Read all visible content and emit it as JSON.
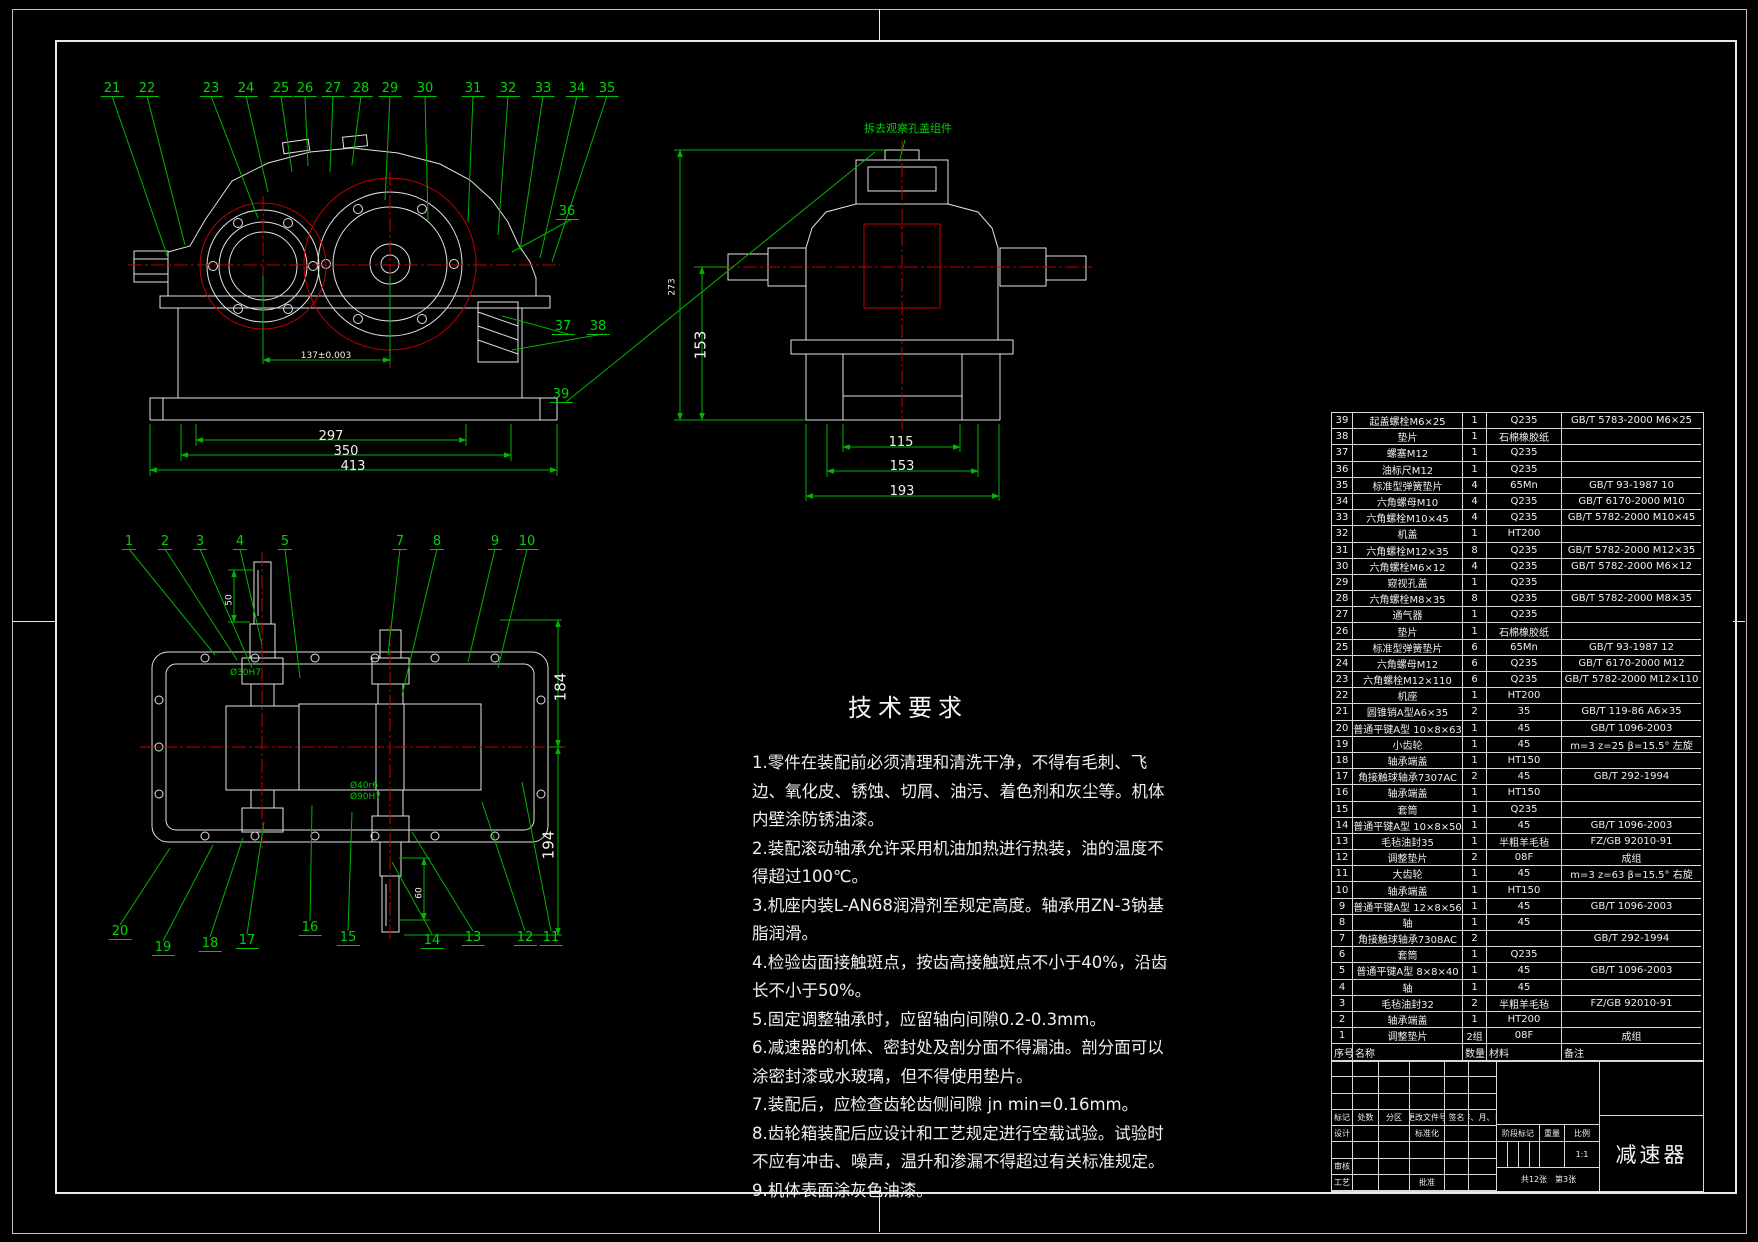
{
  "note": "拆去观察孔盖组件",
  "tech_requirements": {
    "title": "技术要求",
    "items": [
      "1.零件在装配前必须清理和清洗干净，不得有毛刺、飞边、氧化皮、锈蚀、切屑、油污、着色剂和灰尘等。机体内壁涂防锈油漆。",
      "2.装配滚动轴承允许采用机油加热进行热装，油的温度不得超过100℃。",
      "3.机座内装L-AN68润滑剂至规定高度。轴承用ZN-3钠基脂润滑。",
      "4.检验齿面接触斑点，按齿高接触斑点不小于40%，沿齿长不小于50%。",
      "5.固定调整轴承时，应留轴向间隙0.2-0.3mm。",
      "6.减速器的机体、密封处及剖分面不得漏油。剖分面可以涂密封漆或水玻璃，但不得使用垫片。",
      "7.装配后，应检查齿轮齿侧间隙 jn min=0.16mm。",
      "8.齿轮箱装配后应设计和工艺规定进行空载试验。试验时不应有冲击、噪声，温升和渗漏不得超过有关标准规定。",
      "9.机体表面涂灰色油漆。"
    ]
  },
  "balloons": {
    "top": [
      "21",
      "22",
      "23",
      "24",
      "25",
      "26",
      "27",
      "28",
      "29",
      "30",
      "31",
      "32",
      "33",
      "34",
      "35"
    ],
    "right": [
      "36",
      "37",
      "38",
      "39"
    ],
    "plan_top": [
      "1",
      "2",
      "3",
      "4",
      "5",
      "7",
      "8",
      "9",
      "10"
    ],
    "plan_bottom": [
      "20",
      "19",
      "18",
      "17",
      "16",
      "15",
      "14",
      "13",
      "12",
      "11"
    ]
  },
  "dimensions": {
    "front": {
      "width1": "297",
      "width2": "350",
      "width3": "413",
      "center_distance": "137±0.003"
    },
    "side": {
      "height_total": "273",
      "height_base": "153",
      "base_w1": "115",
      "base_w2": "153",
      "base_w3": "193"
    },
    "plan": {
      "half_top": "184",
      "half_bottom": "194",
      "shaft_end_top": "50",
      "shaft_end_bottom": "60",
      "fit1": "Ø30H7",
      "fit2": "Ø40r6",
      "fit3": "Ø90H7"
    }
  },
  "bom": {
    "headers": [
      "序号",
      "名称",
      "数量",
      "材料",
      "备注"
    ],
    "rows": [
      [
        "39",
        "起盖螺栓M6×25",
        "1",
        "Q235",
        "GB/T 5783-2000 M6×25"
      ],
      [
        "38",
        "垫片",
        "1",
        "石棉橡胶纸",
        ""
      ],
      [
        "37",
        "螺塞M12",
        "1",
        "Q235",
        ""
      ],
      [
        "36",
        "油标尺M12",
        "1",
        "Q235",
        ""
      ],
      [
        "35",
        "标准型弹簧垫片",
        "4",
        "65Mn",
        "GB/T 93-1987 10"
      ],
      [
        "34",
        "六角螺母M10",
        "4",
        "Q235",
        "GB/T 6170-2000 M10"
      ],
      [
        "33",
        "六角螺栓M10×45",
        "4",
        "Q235",
        "GB/T 5782-2000 M10×45"
      ],
      [
        "32",
        "机盖",
        "1",
        "HT200",
        ""
      ],
      [
        "31",
        "六角螺栓M12×35",
        "8",
        "Q235",
        "GB/T 5782-2000 M12×35"
      ],
      [
        "30",
        "六角螺栓M6×12",
        "4",
        "Q235",
        "GB/T 5782-2000 M6×12"
      ],
      [
        "29",
        "窥视孔盖",
        "1",
        "Q235",
        ""
      ],
      [
        "28",
        "六角螺栓M8×35",
        "8",
        "Q235",
        "GB/T 5782-2000 M8×35"
      ],
      [
        "27",
        "通气器",
        "1",
        "Q235",
        ""
      ],
      [
        "26",
        "垫片",
        "1",
        "石棉橡胶纸",
        ""
      ],
      [
        "25",
        "标准型弹簧垫片",
        "6",
        "65Mn",
        "GB/T 93-1987 12"
      ],
      [
        "24",
        "六角螺母M12",
        "6",
        "Q235",
        "GB/T 6170-2000 M12"
      ],
      [
        "23",
        "六角螺栓M12×110",
        "6",
        "Q235",
        "GB/T 5782-2000 M12×110"
      ],
      [
        "22",
        "机座",
        "1",
        "HT200",
        ""
      ],
      [
        "21",
        "圆锥销A型A6×35",
        "2",
        "35",
        "GB/T 119-86 A6×35"
      ],
      [
        "20",
        "普通平键A型 10×8×63",
        "1",
        "45",
        "GB/T 1096-2003"
      ],
      [
        "19",
        "小齿轮",
        "1",
        "45",
        "m=3 z=25 β=15.5° 左旋"
      ],
      [
        "18",
        "轴承端盖",
        "1",
        "HT150",
        ""
      ],
      [
        "17",
        "角接触球轴承7307AC",
        "2",
        "45",
        "GB/T 292-1994"
      ],
      [
        "16",
        "轴承端盖",
        "1",
        "HT150",
        ""
      ],
      [
        "15",
        "套筒",
        "1",
        "Q235",
        ""
      ],
      [
        "14",
        "普通平键A型 10×8×50",
        "1",
        "45",
        "GB/T 1096-2003"
      ],
      [
        "13",
        "毛毡油封35",
        "1",
        "半粗羊毛毡",
        "FZ/GB 92010-91"
      ],
      [
        "12",
        "调整垫片",
        "2",
        "08F",
        "成组"
      ],
      [
        "11",
        "大齿轮",
        "1",
        "45",
        "m=3 z=63 β=15.5° 右旋"
      ],
      [
        "10",
        "轴承端盖",
        "1",
        "HT150",
        ""
      ],
      [
        "9",
        "普通平键A型 12×8×56",
        "1",
        "45",
        "GB/T 1096-2003"
      ],
      [
        "8",
        "轴",
        "1",
        "45",
        ""
      ],
      [
        "7",
        "角接触球轴承7308AC",
        "2",
        "",
        "GB/T 292-1994"
      ],
      [
        "6",
        "套筒",
        "1",
        "Q235",
        ""
      ],
      [
        "5",
        "普通平键A型 8×8×40",
        "1",
        "45",
        "GB/T 1096-2003"
      ],
      [
        "4",
        "轴",
        "1",
        "45",
        ""
      ],
      [
        "3",
        "毛毡油封32",
        "2",
        "半粗羊毛毡",
        "FZ/GB 92010-91"
      ],
      [
        "2",
        "轴承端盖",
        "1",
        "HT200",
        ""
      ],
      [
        "1",
        "调整垫片",
        "2组",
        "08F",
        "成组"
      ]
    ]
  },
  "title_block": {
    "part_name": "减速器",
    "mark": "标记",
    "count": "处数",
    "zone": "分区",
    "doc_no": "更改文件号",
    "sign": "签名",
    "date": "年、月、日",
    "design": "设计",
    "standardize": "标准化",
    "check": "审核",
    "process": "工艺",
    "approve": "批准",
    "stage": "阶段标记",
    "weight": "重量",
    "scale": "比例",
    "scale_value": "1:1",
    "sheets_total": "共12张",
    "sheet_no": "第3张"
  },
  "colors": {
    "line": "#e2e2e2",
    "green": "#00b400",
    "red": "#c40000",
    "background": "#000000"
  }
}
